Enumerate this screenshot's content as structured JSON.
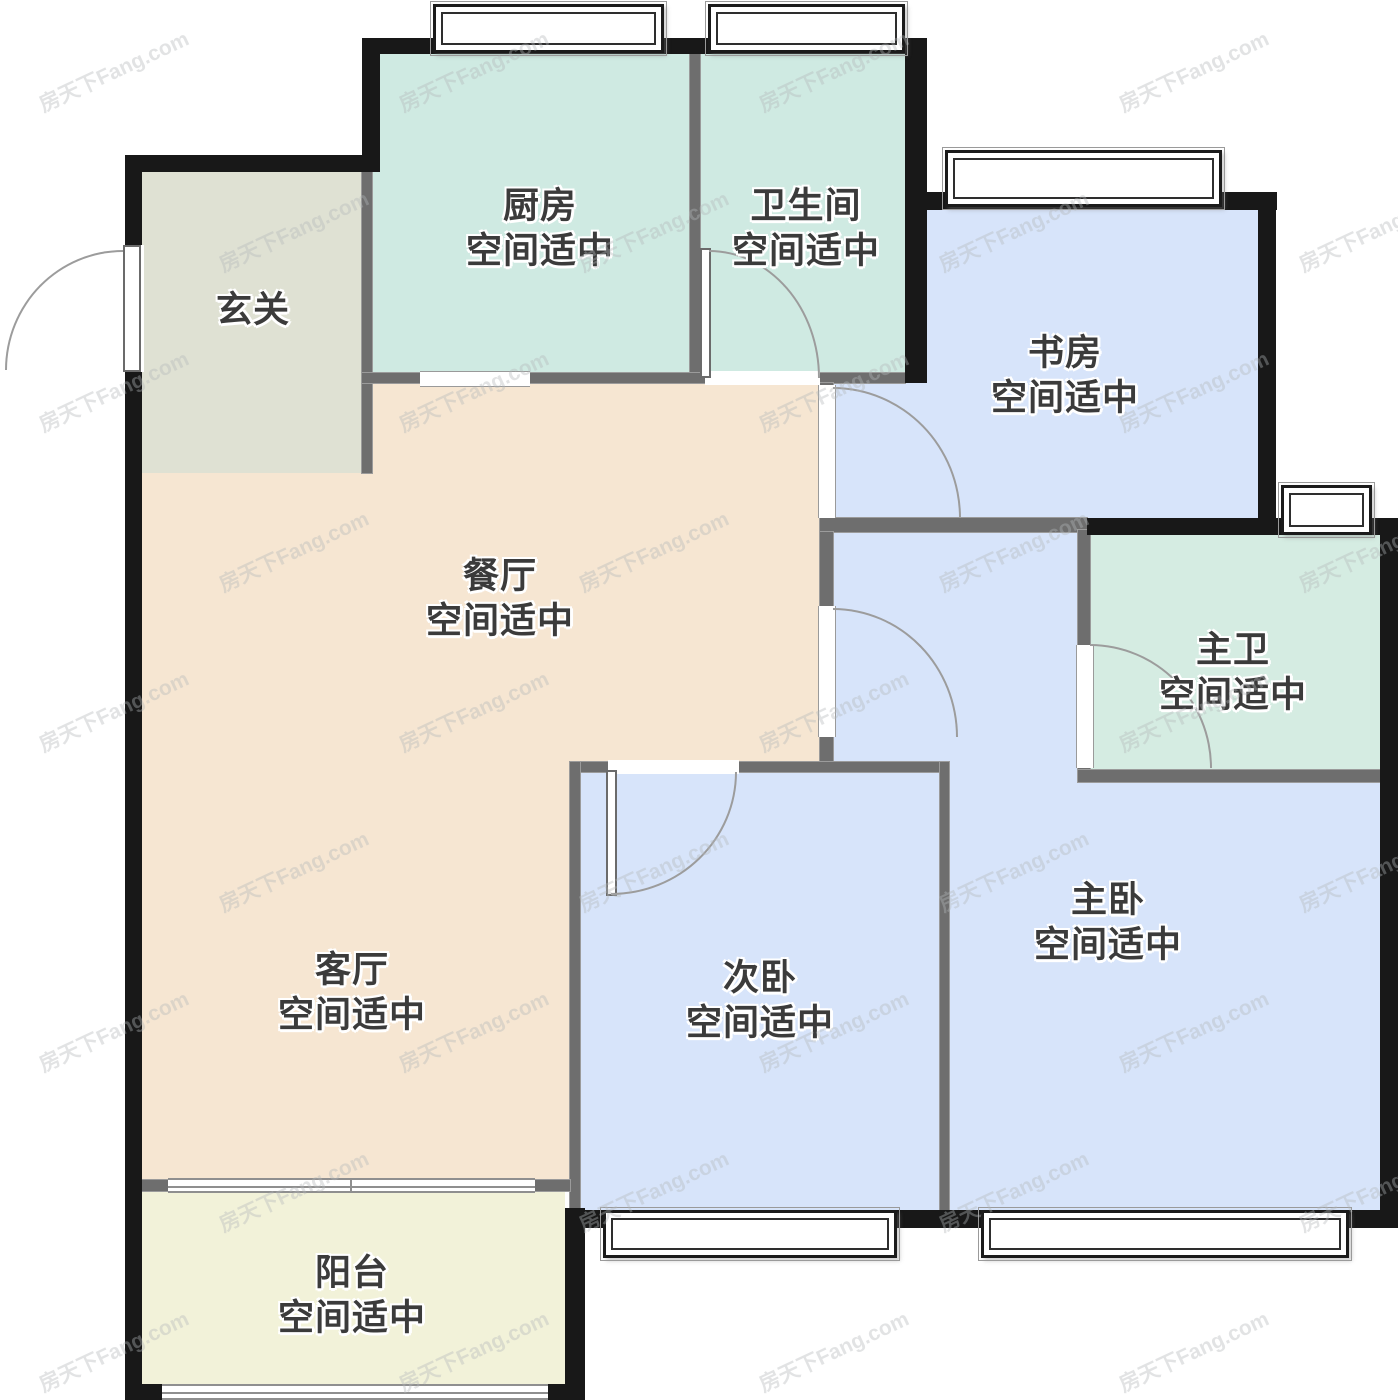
{
  "title": "户型图",
  "watermark": {
    "text": "房天下Fang.com",
    "color": "#b4b8ba"
  },
  "walls": {
    "outer_color": "#181818",
    "inner_color": "#6e6e6e"
  },
  "rooms": [
    {
      "id": "entry",
      "name": "玄关",
      "status": "",
      "color": "#dfe1d3"
    },
    {
      "id": "kitchen",
      "name": "厨房",
      "status": "空间适中",
      "color": "#cfeae2"
    },
    {
      "id": "bathroom",
      "name": "卫生间",
      "status": "空间适中",
      "color": "#cfeae2"
    },
    {
      "id": "study",
      "name": "书房",
      "status": "空间适中",
      "color": "#d7e4fa"
    },
    {
      "id": "dining",
      "name": "餐厅",
      "status": "空间适中",
      "color": "#f6e6d2"
    },
    {
      "id": "master-bath",
      "name": "主卫",
      "status": "空间适中",
      "color": "#d5ece2"
    },
    {
      "id": "living",
      "name": "客厅",
      "status": "空间适中",
      "color": "#f6e6d2"
    },
    {
      "id": "second-bedroom",
      "name": "次卧",
      "status": "空间适中",
      "color": "#d7e4fa"
    },
    {
      "id": "master-bedroom",
      "name": "主卧",
      "status": "空间适中",
      "color": "#d7e4fa"
    },
    {
      "id": "balcony",
      "name": "阳台",
      "status": "空间适中",
      "color": "#f2f2d9"
    }
  ]
}
